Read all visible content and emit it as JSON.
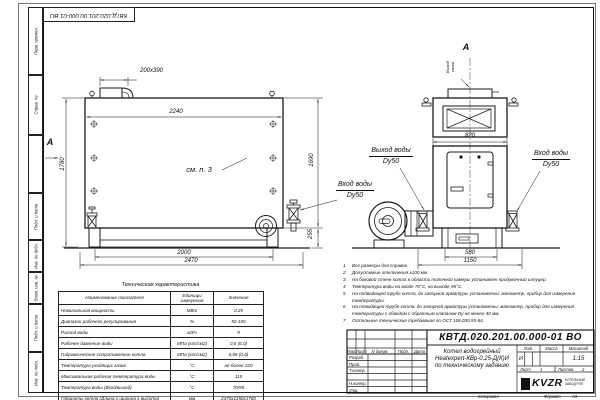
{
  "stamp": {
    "doc_number_top": "КВТД.020.201.00.000-01 ВО"
  },
  "margin_boxes": [
    "Перв. примен.",
    "Справ. №",
    "Подп. и дата",
    "Инв. № дубл.",
    "Взам. инв. №",
    "Подп. и дата",
    "Инв. № подл."
  ],
  "labels": {
    "section_a": "А",
    "view_a": "А",
    "see_note": "см. п. 3",
    "gas_out_1": "Выход",
    "gas_out_2": "газов",
    "water_out_1": "Выход воды",
    "water_out_2": "Dy50",
    "water_in_1": "Вход воды",
    "water_in_2": "Dy50"
  },
  "dims": {
    "flue": "200х390",
    "body_len": "2240",
    "height": "1780",
    "rear_h": "1690",
    "base_h": "255",
    "legs": "2000",
    "total_len": "2470",
    "front_w": "820",
    "front_base": "580",
    "front_total": "1150"
  },
  "tech": {
    "title": "Техническая характеристика",
    "col_name": "Наименование показателя",
    "col_units": "Единицы измерения",
    "col_value": "Значение",
    "rows": [
      [
        "Номинальная мощность",
        "МВт",
        "0,25"
      ],
      [
        "Диапазон рабочего регулирования",
        "%",
        "50-100"
      ],
      [
        "Расход воды",
        "м3/ч",
        "9"
      ],
      [
        "Рабочее давление воды",
        "МПа (кгс/см2)",
        "0,6 (6,0)"
      ],
      [
        "Гидравлическое сопротивление котла",
        "МПа (кгс/см2)",
        "0,06 (0,6)"
      ],
      [
        "Температура уходящих газов",
        "°С",
        "не более 220"
      ],
      [
        "Максимальная рабочая температура воды",
        "°С",
        "115"
      ],
      [
        "Температура воды (Вход/выход)",
        "°С",
        "70/95"
      ],
      [
        "Габариты котла (Длина х ширина х высота)",
        "мм",
        "2470х1150х1780"
      ]
    ]
  },
  "notes": {
    "items": [
      {
        "n": "1",
        "text": "Все размеры для справок."
      },
      {
        "n": "2",
        "text": "Допустимые отклонения ±100 мм."
      },
      {
        "n": "3",
        "text": "На боковой стене котла в области топочной камеры установлен продувочный штуцер."
      },
      {
        "n": "4",
        "text": "Температура воды на входе 70°С, на выходе 95°С."
      },
      {
        "n": "5",
        "text": "На подводящей трубе котла, до запорной арматуры установлены: манометр, прибор для измерения температуры."
      },
      {
        "n": "6",
        "text": "На отводящей трубе котла, до запорной арматуры установлены: манометр, прибор для измерения температуры с обводом с обратным клапаном Dу не менее 40 мм."
      },
      {
        "n": "7",
        "text": "Остальные технические требования по ОСТ 108.030.55-84."
      }
    ]
  },
  "title_block": {
    "doc_number": "КВТД.020.201.00.000-01 ВО",
    "product_line1": "Котел водогрейный",
    "product_line2": "Heatexpert-КВр-0,25-Д(К)И",
    "product_line3": "по техническому заданию",
    "col_izm": "Изм.",
    "col_list": "Лист",
    "col_doc": "N докум.",
    "col_podp": "Подп.",
    "col_data": "Дата",
    "row_razrab": "Разраб.",
    "row_prov": "Пров.",
    "row_tkontr": "Т.контр.",
    "row_nkontr": "Н.контр.",
    "row_utv": "Утв.",
    "lit_label": "Лит.",
    "lit_value": "И",
    "massa_label": "Масса",
    "masshtab_label": "Масштаб",
    "masshtab_value": "1:15",
    "list_label": "Лист",
    "list_value": "1",
    "listov_label": "Листов",
    "listov_value": "2",
    "logo_text": "KVZR",
    "logo_sub1": "КОТЕЛЬНЫЙ",
    "logo_sub2": "ЗАВОД РЭП",
    "kopiroval": "Копировал",
    "format_label": "Формат",
    "format_value": "А3"
  }
}
